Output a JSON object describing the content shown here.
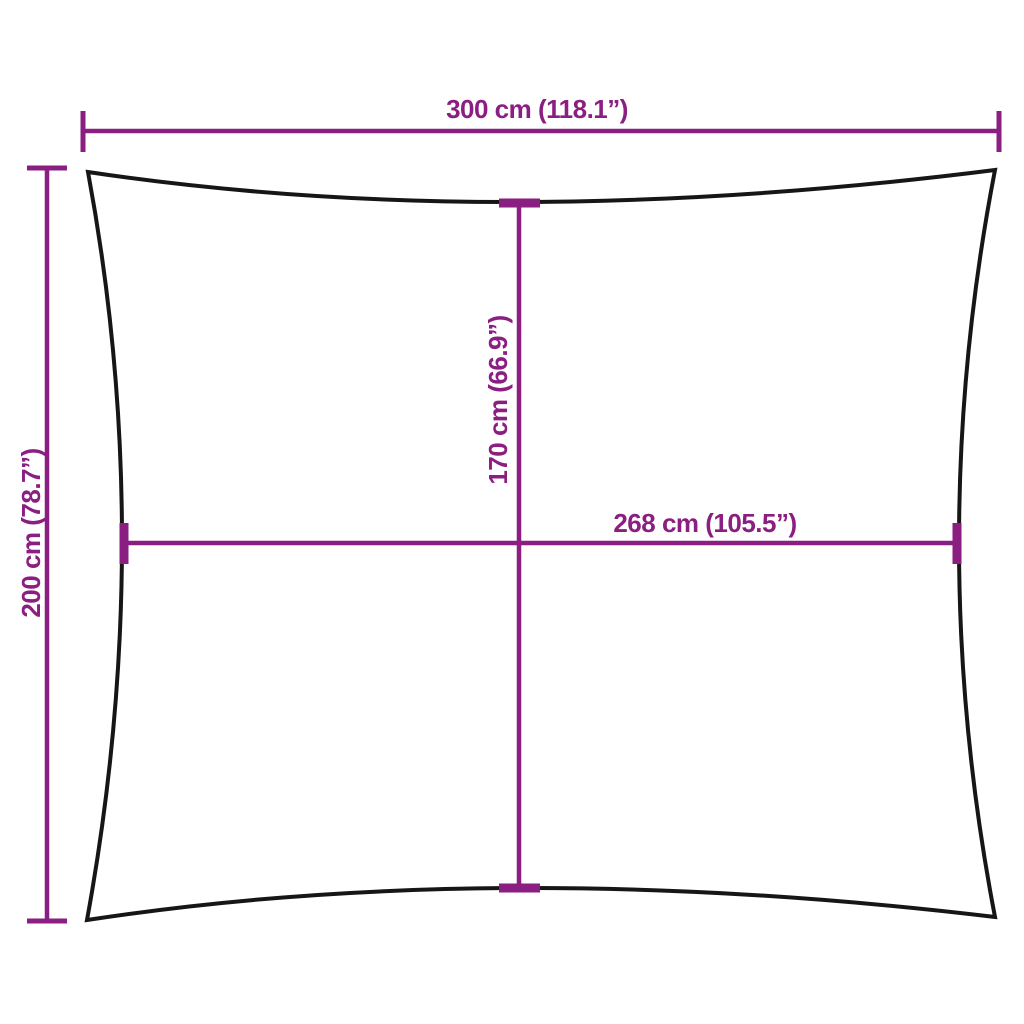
{
  "diagram": {
    "colors": {
      "background": "#ffffff",
      "sail_outline": "#161616",
      "dimension": "#8B1E81"
    },
    "measurements": {
      "overall_width": {
        "label": "300 cm (118.1”)"
      },
      "overall_height": {
        "label": "200 cm (78.7”)"
      },
      "inner_height": {
        "label": "170 cm (66.9”)"
      },
      "inner_width": {
        "label": "268 cm (105.5”)"
      }
    }
  }
}
